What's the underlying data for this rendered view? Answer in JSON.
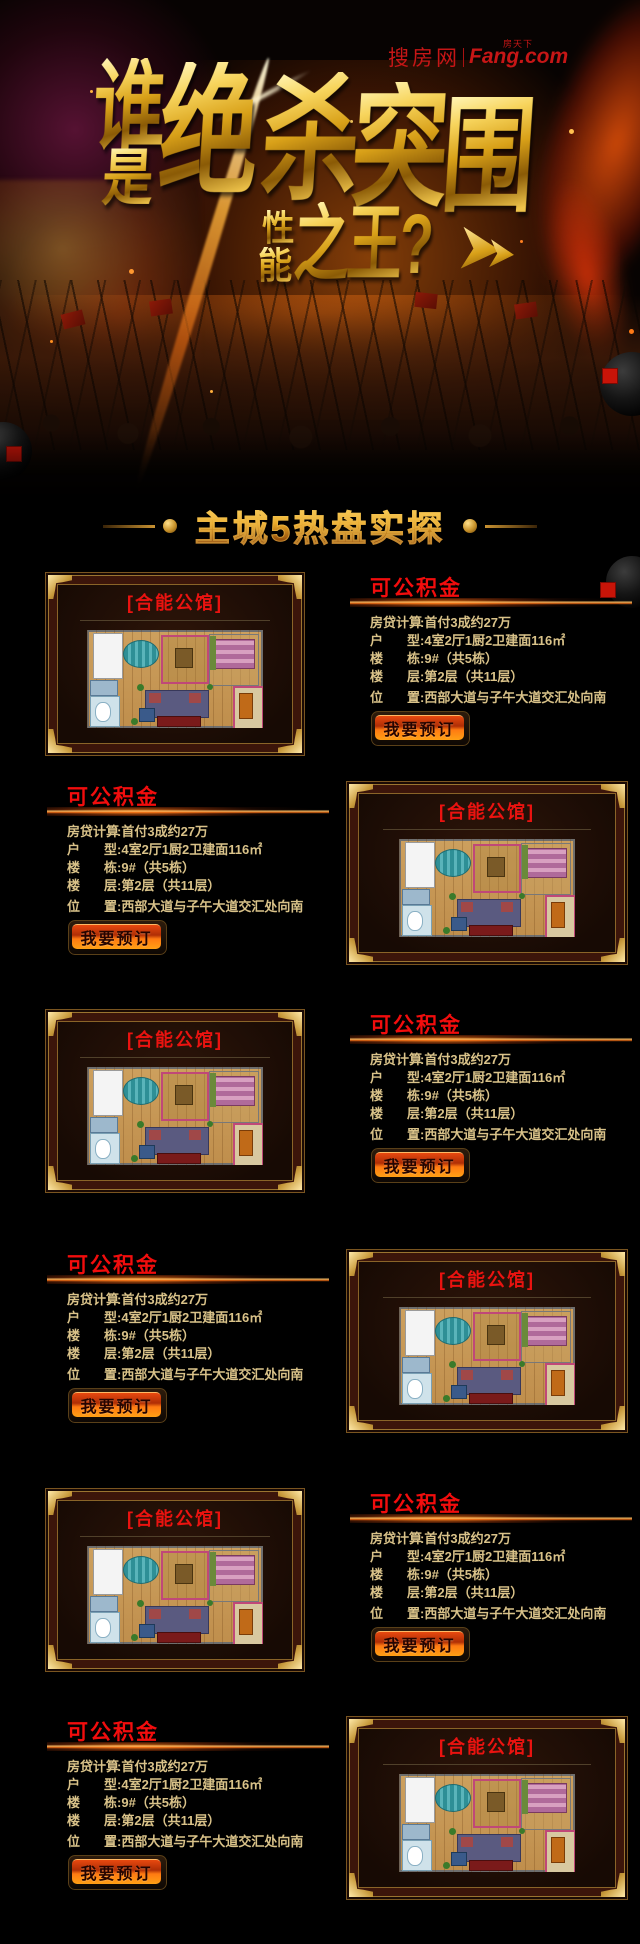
{
  "banner": {
    "logo": {
      "cn": "搜房网",
      "sub": "房天下",
      "en": "Fang.com"
    },
    "title": {
      "shei": "谁",
      "shi": "是",
      "jue": "绝",
      "sha": "杀",
      "tu": "突",
      "wei": "围",
      "xing": "性",
      "neng": "能",
      "zhiwang": "之王?"
    }
  },
  "section": {
    "title": "主城5热盘实探"
  },
  "listings": [
    {
      "project": "[合能公馆]",
      "tag": "可公积金",
      "button": "我要预订",
      "rows": [
        {
          "label": "房贷计算",
          "sep": ":",
          "value": "首付3成约27万"
        },
        {
          "label": "户型",
          "sep": ":",
          "value": "4室2厅1厨2卫建面116㎡"
        },
        {
          "label": "楼栋",
          "sep": ":",
          "value": "9#（共5栋）"
        },
        {
          "label": "楼层",
          "sep": ":",
          "value": "第2层（共11层）"
        },
        {
          "label": "位置",
          "sep": ":",
          "value": "西部大道与子午大道交汇处向南"
        }
      ]
    },
    {
      "project": "[合能公馆]",
      "tag": "可公积金",
      "button": "我要预订",
      "rows": [
        {
          "label": "房贷计算",
          "sep": ":",
          "value": "首付3成约27万"
        },
        {
          "label": "户型",
          "sep": ":",
          "value": "4室2厅1厨2卫建面116㎡"
        },
        {
          "label": "楼栋",
          "sep": ":",
          "value": "9#（共5栋）"
        },
        {
          "label": "楼层",
          "sep": ":",
          "value": "第2层（共11层）"
        },
        {
          "label": "位置",
          "sep": ":",
          "value": "西部大道与子午大道交汇处向南"
        }
      ]
    },
    {
      "project": "[合能公馆]",
      "tag": "可公积金",
      "button": "我要预订",
      "rows": [
        {
          "label": "房贷计算",
          "sep": ":",
          "value": "首付3成约27万"
        },
        {
          "label": "户型",
          "sep": ":",
          "value": "4室2厅1厨2卫建面116㎡"
        },
        {
          "label": "楼栋",
          "sep": ":",
          "value": "9#（共5栋）"
        },
        {
          "label": "楼层",
          "sep": ":",
          "value": "第2层（共11层）"
        },
        {
          "label": "位置",
          "sep": ":",
          "value": "西部大道与子午大道交汇处向南"
        }
      ]
    },
    {
      "project": "[合能公馆]",
      "tag": "可公积金",
      "button": "我要预订",
      "rows": [
        {
          "label": "房贷计算",
          "sep": ":",
          "value": "首付3成约27万"
        },
        {
          "label": "户型",
          "sep": ":",
          "value": "4室2厅1厨2卫建面116㎡"
        },
        {
          "label": "楼栋",
          "sep": ":",
          "value": "9#（共5栋）"
        },
        {
          "label": "楼层",
          "sep": ":",
          "value": "第2层（共11层）"
        },
        {
          "label": "位置",
          "sep": ":",
          "value": "西部大道与子午大道交汇处向南"
        }
      ]
    },
    {
      "project": "[合能公馆]",
      "tag": "可公积金",
      "button": "我要预订",
      "rows": [
        {
          "label": "房贷计算",
          "sep": ":",
          "value": "首付3成约27万"
        },
        {
          "label": "户型",
          "sep": ":",
          "value": "4室2厅1厨2卫建面116㎡"
        },
        {
          "label": "楼栋",
          "sep": ":",
          "value": "9#（共5栋）"
        },
        {
          "label": "楼层",
          "sep": ":",
          "value": "第2层（共11层）"
        },
        {
          "label": "位置",
          "sep": ":",
          "value": "西部大道与子午大道交汇处向南"
        }
      ]
    },
    {
      "project": "[合能公馆]",
      "tag": "可公积金",
      "button": "我要预订",
      "rows": [
        {
          "label": "房贷计算",
          "sep": ":",
          "value": "首付3成约27万"
        },
        {
          "label": "户型",
          "sep": ":",
          "value": "4室2厅1厨2卫建面116㎡"
        },
        {
          "label": "楼栋",
          "sep": ":",
          "value": "9#（共5栋）"
        },
        {
          "label": "楼层",
          "sep": ":",
          "value": "第2层（共11层）"
        },
        {
          "label": "位置",
          "sep": ":",
          "value": "西部大道与子午大道交汇处向南"
        }
      ]
    }
  ],
  "colors": {
    "accent_gold": "#e8b93e",
    "title_red": "#f20d0d",
    "button_orange": "#ff7a12",
    "text_gold": "#d9c289"
  }
}
